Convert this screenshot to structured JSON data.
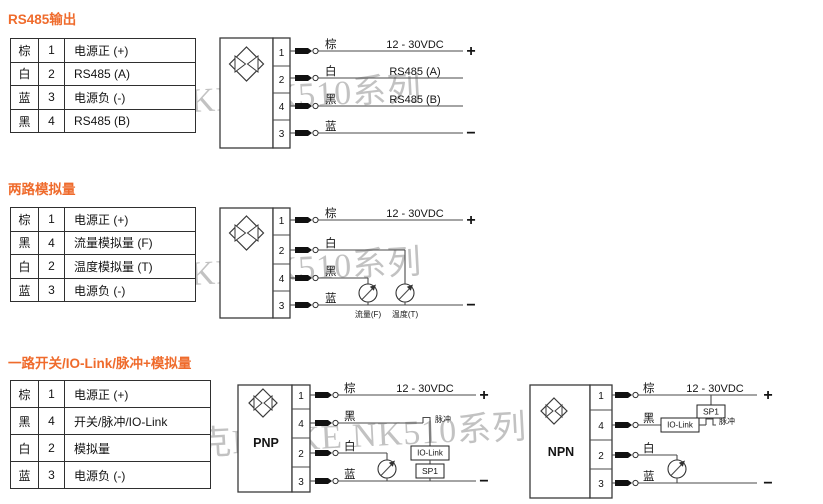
{
  "colors": {
    "title_orange": "#ef6b2c",
    "diagram_line": "#4a4a4a",
    "table_border": "#2f2f2f",
    "watermark_gray": "#c2c2c2"
  },
  "watermark": "泉克NOIKE NK510系列",
  "sections": [
    {
      "title": "RS485输出",
      "table": [
        {
          "color": "棕",
          "pin": "1",
          "desc": "电源正 (+)"
        },
        {
          "color": "白",
          "pin": "2",
          "desc": "RS485 (A)"
        },
        {
          "color": "蓝",
          "pin": "3",
          "desc": "电源负 (-)"
        },
        {
          "color": "黑",
          "pin": "4",
          "desc": "RS485 (B)"
        }
      ],
      "diagram": {
        "pins": [
          "1",
          "2",
          "4",
          "3"
        ],
        "brown": {
          "label": "棕",
          "line": "12 - 30VDC",
          "terminal": "+"
        },
        "white": {
          "label": "白",
          "line": "RS485 (A)"
        },
        "black": {
          "label": "黑",
          "line": "RS485 (B)"
        },
        "blue": {
          "label": "蓝",
          "terminal": "−"
        }
      }
    },
    {
      "title": "两路模拟量",
      "table": [
        {
          "color": "棕",
          "pin": "1",
          "desc": "电源正 (+)"
        },
        {
          "color": "黑",
          "pin": "4",
          "desc": "流量模拟量 (F)"
        },
        {
          "color": "白",
          "pin": "2",
          "desc": "温度模拟量 (T)"
        },
        {
          "color": "蓝",
          "pin": "3",
          "desc": "电源负 (-)"
        }
      ],
      "diagram": {
        "pins": [
          "1",
          "2",
          "4",
          "3"
        ],
        "brown": {
          "label": "棕",
          "line": "12 - 30VDC",
          "terminal": "+"
        },
        "white": {
          "label": "白"
        },
        "black": {
          "label": "黑"
        },
        "blue": {
          "label": "蓝",
          "terminal": "−"
        },
        "flow_meter": "流量(F)",
        "temp_meter": "温度(T)"
      }
    },
    {
      "title": "一路开关/IO-Link/脉冲+模拟量",
      "table": [
        {
          "color": "棕",
          "pin": "1",
          "desc": "电源正 (+)"
        },
        {
          "color": "黑",
          "pin": "4",
          "desc": "开关/脉冲/IO-Link"
        },
        {
          "color": "白",
          "pin": "2",
          "desc": "模拟量"
        },
        {
          "color": "蓝",
          "pin": "3",
          "desc": "电源负 (-)"
        }
      ],
      "pnp": {
        "type": "PNP",
        "pins": [
          "1",
          "4",
          "2",
          "3"
        ],
        "brown": {
          "label": "棕",
          "line": "12 - 30VDC",
          "terminal": "+"
        },
        "black": {
          "label": "黑"
        },
        "white": {
          "label": "白"
        },
        "blue": {
          "label": "蓝",
          "terminal": "−"
        },
        "pulse": "脉冲",
        "iolink": "IO-Link",
        "sp1": "SP1"
      },
      "npn": {
        "type": "NPN",
        "pins": [
          "1",
          "4",
          "2",
          "3"
        ],
        "brown": {
          "label": "棕",
          "line": "12 - 30VDC",
          "terminal": "+"
        },
        "black": {
          "label": "黑"
        },
        "white": {
          "label": "白"
        },
        "blue": {
          "label": "蓝",
          "terminal": "−"
        },
        "pulse": "脉冲",
        "iolink": "IO-Link",
        "sp1": "SP1"
      }
    }
  ]
}
